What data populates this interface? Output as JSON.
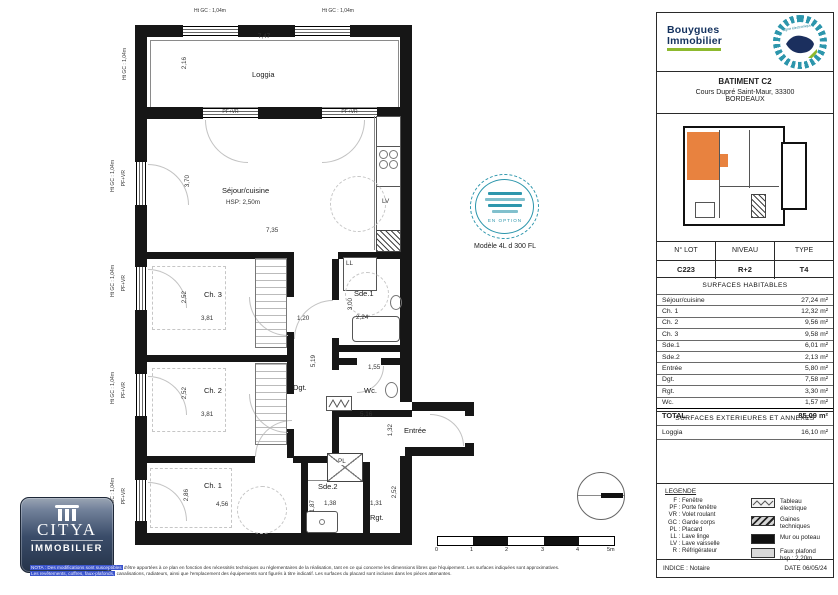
{
  "plan": {
    "labels": {
      "loggia": "Loggia",
      "loggia_w": "7,47",
      "loggia_h": "2,16",
      "ht_gc": "Ht GC : 1,04m",
      "pf_vr": "PF+VR",
      "sejour": "Séjour/cuisine",
      "sejour_hsp": "HSP: 2,50m",
      "sejour_h": "3,70",
      "sejour_w": "7,35",
      "lv": "LV",
      "ll": "LL",
      "pl": "PL",
      "ch3": "Ch. 3",
      "ch3_h": "2,52",
      "ch3_w": "3,81",
      "hall_w": "1,20",
      "sde1": "Sde.1",
      "sde1_h": "3,00",
      "sde1_w": "2,24",
      "dgt": "Dgt.",
      "dgt_h": "5,19",
      "ch2": "Ch. 2",
      "ch2_h": "2,52",
      "ch2_w": "3,81",
      "wc": "Wc.",
      "wc_w": "1,55",
      "entree": "Entrée",
      "entree_w": "5,16",
      "entree_h": "1,32",
      "ch1": "Ch. 1",
      "ch1_h": "2,86",
      "ch1_w": "4,56",
      "sde2": "Sde.2",
      "sde2_w": "1,38",
      "sde2_h": "1,87",
      "rgt": "Rgt.",
      "rgt_w": "1,31",
      "rgt_h": "2,52"
    },
    "stamp": {
      "text": "EN OPTION",
      "caption": "Modèle 4L d 300 FL"
    },
    "scale": {
      "ticks": [
        "0",
        "1",
        "2",
        "3",
        "4",
        "5m"
      ]
    }
  },
  "sidebar": {
    "brand": {
      "name_line1": "Bouygues",
      "name_line2": "Immobilier",
      "stamp": "signé électroniquement"
    },
    "building": {
      "name": "BATIMENT C2",
      "address1": "Cours Dupré Saint-Maur, 33300",
      "address2": "BORDEAUX"
    },
    "lot": {
      "headers": [
        "N° LOT",
        "NIVEAU",
        "TYPE"
      ],
      "values": [
        "C223",
        "R+2",
        "T4"
      ]
    },
    "surfaces": {
      "title": "SURFACES HABITABLES",
      "rows": [
        {
          "label": "Séjour/cuisine",
          "value": "27,24 m²"
        },
        {
          "label": "Ch. 1",
          "value": "12,32 m²"
        },
        {
          "label": "Ch. 2",
          "value": "9,56 m²"
        },
        {
          "label": "Ch. 3",
          "value": "9,58 m²"
        },
        {
          "label": "Sde.1",
          "value": "6,01 m²"
        },
        {
          "label": "Sde.2",
          "value": "2,13 m²"
        },
        {
          "label": "Entrée",
          "value": "5,80 m²"
        },
        {
          "label": "Dgt.",
          "value": "7,58 m²"
        },
        {
          "label": "Rgt.",
          "value": "3,30 m²"
        },
        {
          "label": "Wc.",
          "value": "1,57 m²"
        }
      ],
      "total": {
        "label": "TOTAL",
        "value": "85,09 m²"
      }
    },
    "exterieures": {
      "title": "SURFACES EXTERIEURES ET ANNEXES",
      "rows": [
        {
          "label": "Loggia",
          "value": "16,10 m²"
        }
      ]
    },
    "legende": {
      "title": "LEGENDE",
      "sep": " : ",
      "abbreviations": [
        {
          "abbr": "F",
          "label": "Fenêtre"
        },
        {
          "abbr": "PF",
          "label": "Porte fenêtre"
        },
        {
          "abbr": "VR",
          "label": "Volet roulant"
        },
        {
          "abbr": "GC",
          "label": "Garde corps"
        },
        {
          "abbr": "PL",
          "label": "Placard"
        },
        {
          "abbr": "LL",
          "label": "Lave linge"
        },
        {
          "abbr": "LV",
          "label": "Lave vaisselle"
        },
        {
          "abbr": "R",
          "label": "Réfrigérateur"
        }
      ],
      "swatches": [
        {
          "label": "Tableau électrique"
        },
        {
          "label": "Gaines techniques"
        },
        {
          "label": "Mur ou poteau"
        },
        {
          "label": "Faux plafond",
          "sub": "hsp : 2,20m"
        }
      ]
    },
    "footer": {
      "indice": "INDICE : Notaire",
      "date": "DATE 06/05/24"
    }
  },
  "citya": {
    "name": "CITYA",
    "sub": "IMMOBILIER"
  },
  "nota": {
    "l1_hl": "NOTA : Des modifications sont susceptibles",
    "l1": " d'être apportées à ce plan en fonction des nécessités techniques ou réglementaires de la réalisation, tant en ce qui concerne les dimensions libres que l'équipement. Les surfaces indiquées sont approximatives.",
    "l2_hl": "Les revêtements, coffres, faux-plafonds,",
    "l2": " canalisations, radiateurs, ainsi que l'emplacement des équipements sont figurés à titre indicatif. Les surfaces du placard sont incluses dans les pièces attenantes."
  }
}
